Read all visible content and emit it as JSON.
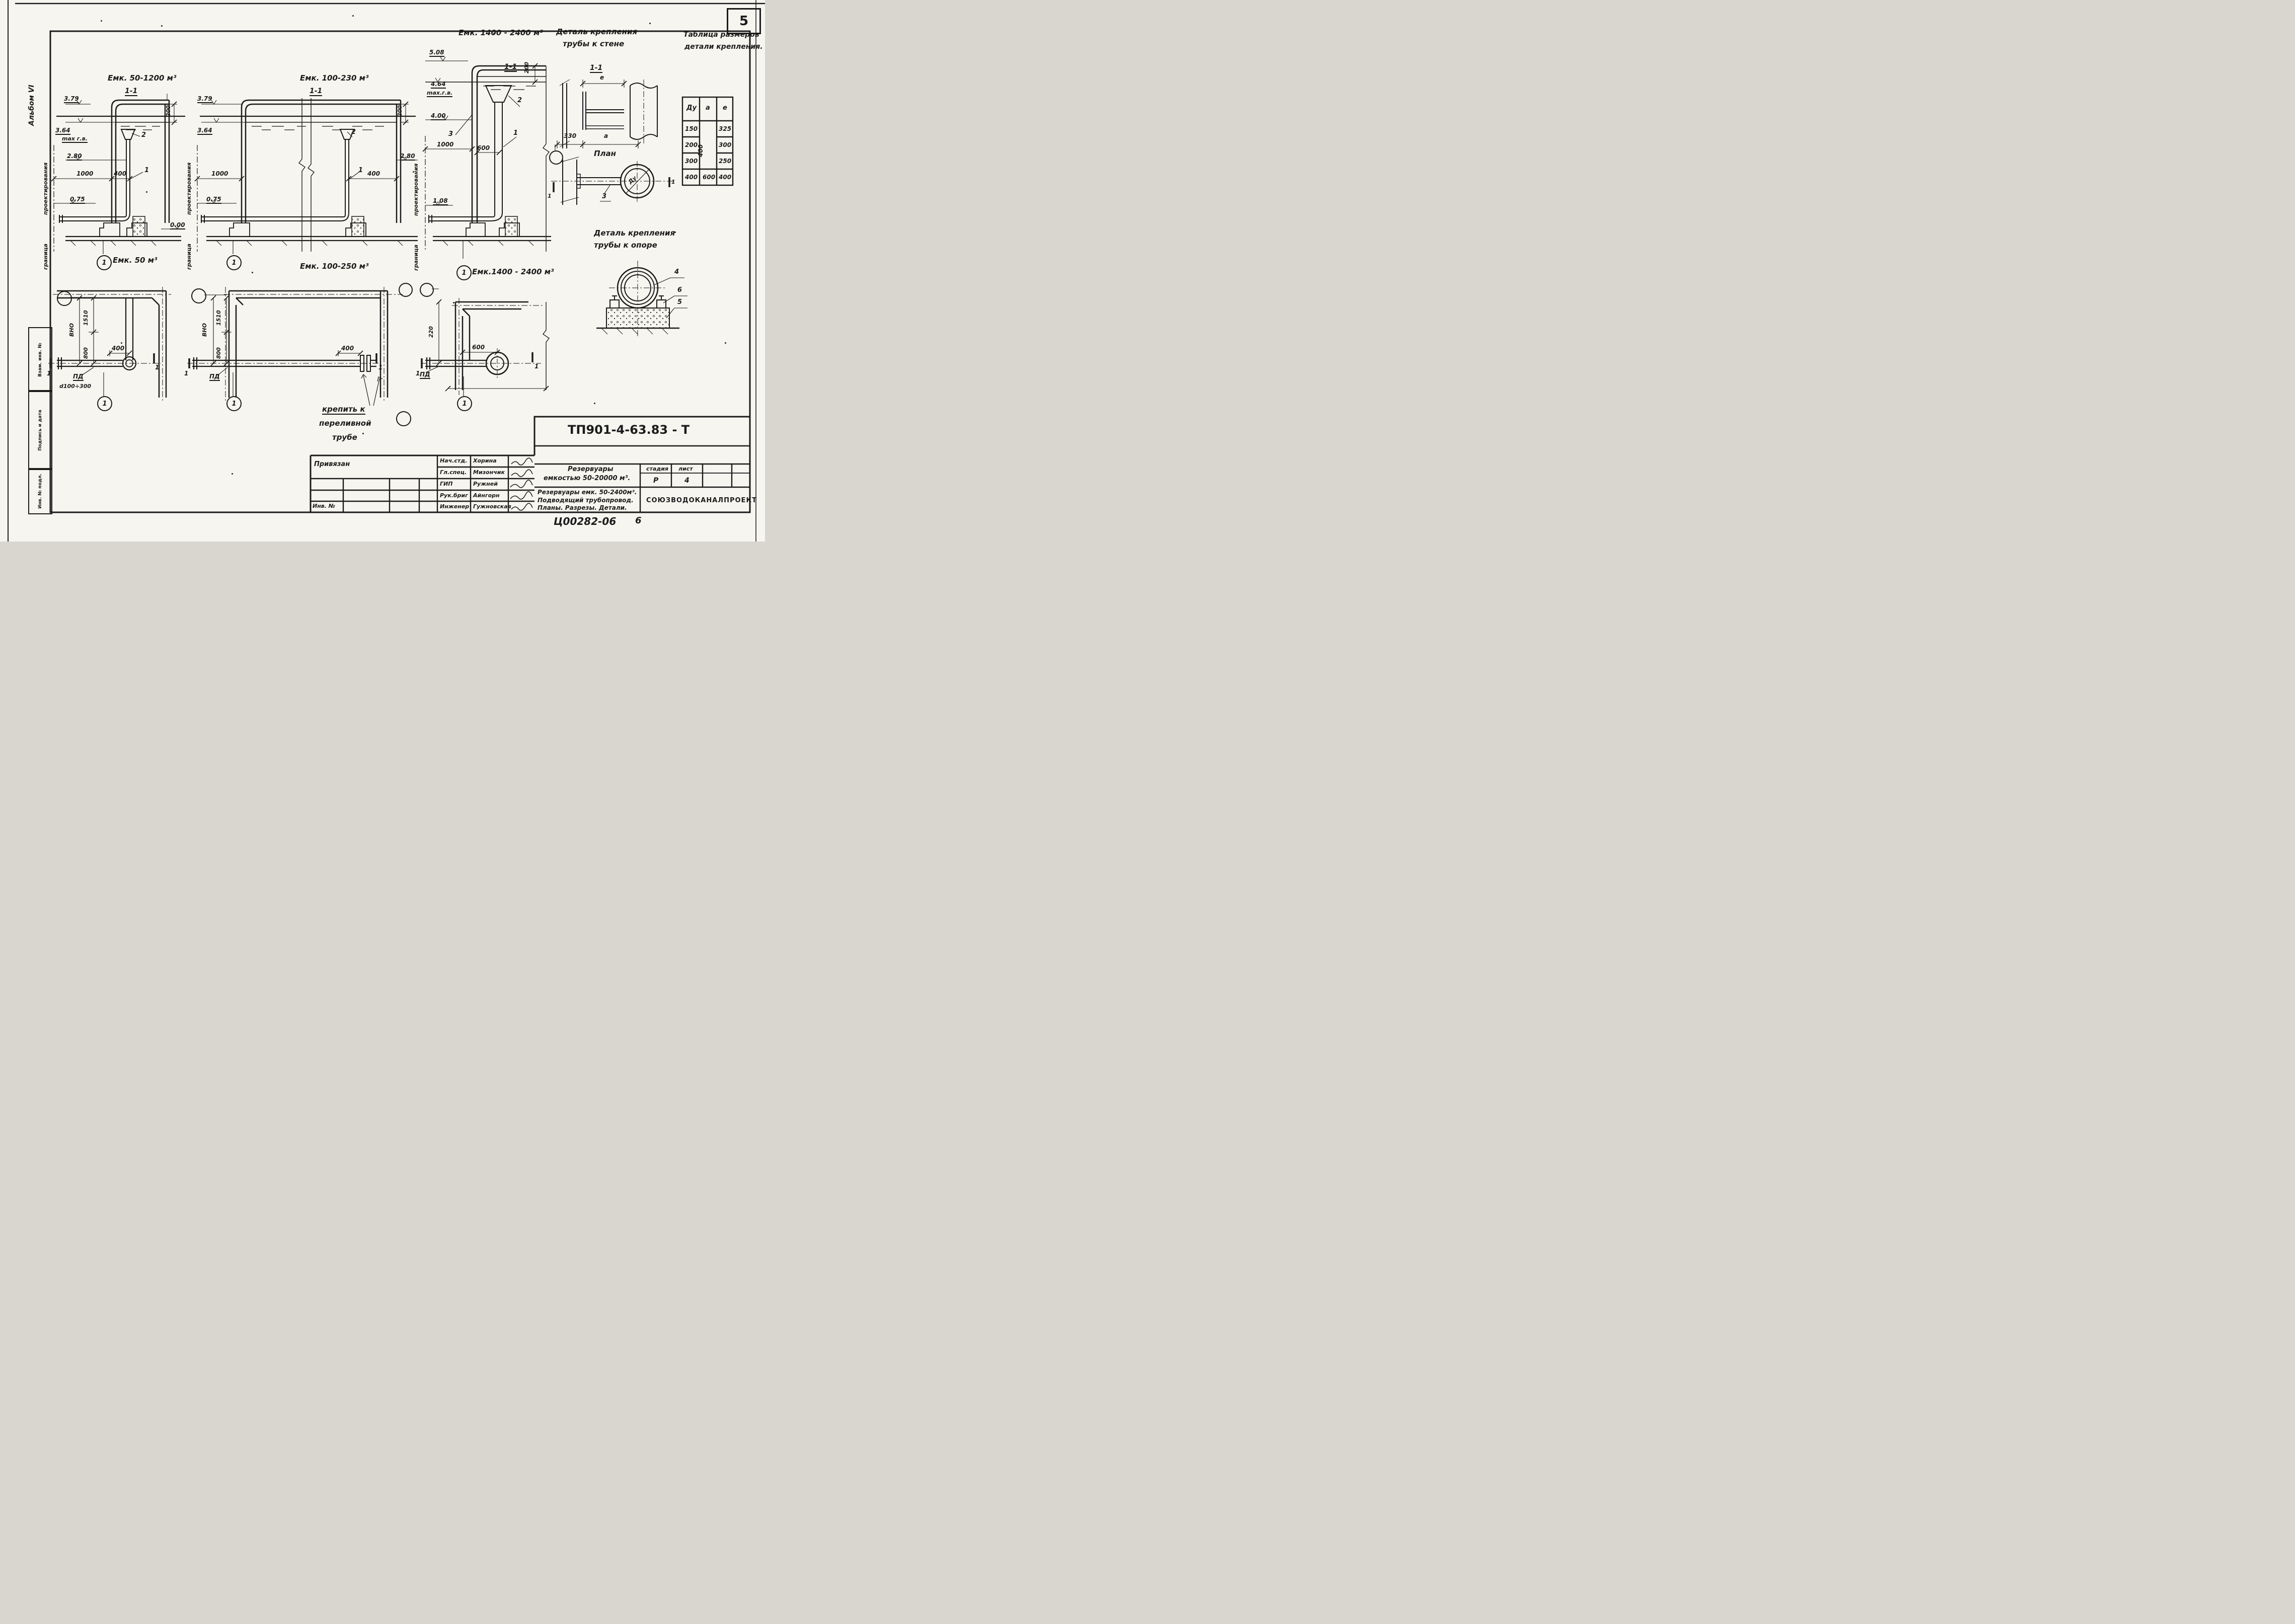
{
  "sheet": {
    "number": "5",
    "album": "Альбом VI",
    "doc_code": "Ц00282-06",
    "doc_page": "6"
  },
  "stamps": {
    "vzam": "Взам. инв. №",
    "podpis": "Подпись и дата",
    "inv_podl": "Инв. № подл."
  },
  "headers": {
    "wall_detail_1": "Деталь крепления",
    "wall_detail_2": "трубы к стене",
    "table_title_1": "Таблица размеров",
    "table_title_2": "детали крепления.",
    "support_detail_1": "Деталь крепления",
    "support_detail_2": "трубы к опоре",
    "plan_label": "План",
    "detail_mark": "1-1"
  },
  "size_table": {
    "col_dy": "Ду",
    "col_a": "а",
    "col_e": "е",
    "dy": [
      "150",
      "200",
      "300",
      "400"
    ],
    "e": [
      "325",
      "300",
      "250",
      "400"
    ],
    "a_merged": "400",
    "a_last": "600"
  },
  "sections": [
    {
      "title": "Емк. 50-1200 м³",
      "mark": "1-1",
      "elev_top": "3.79",
      "elev_water": "3.64",
      "water_note": "max г.в.",
      "roof_dim": "200",
      "elev_mid": "2.80",
      "dim_a": "1000",
      "dim_b": "400",
      "elev_low": "0.75",
      "elev_zero": "0.00",
      "callout_funnel": "2",
      "callout_pipe": "1",
      "boundary_upper": "проектирования",
      "boundary_lower": "граница",
      "bubble": "1",
      "caption": "Емк. 50 м³"
    },
    {
      "title": "Емк. 100-230 м³",
      "mark": "1-1",
      "elev_top": "3.79",
      "elev_water": "3.64",
      "roof_dim": "200",
      "elev_mid": "2.80",
      "dim_a": "1000",
      "dim_b": "400",
      "elev_low": "0.75",
      "callout_funnel": "2",
      "callout_pipe": "1",
      "boundary_upper": "проектирования",
      "boundary_lower": "граница",
      "bubble": "1",
      "caption": "Емк. 100-250 м³"
    },
    {
      "title": "Емк. 1400 - 2400 м³",
      "mark": "1-1",
      "elev_top": "5.08",
      "elev_water": "4.64",
      "water_note": "max.г.в.",
      "roof_dim": "200",
      "elev_funnel": "4.00",
      "dim_a": "1000",
      "dim_b": "600",
      "elev_low": "1.08",
      "callout_funnel": "2",
      "callout_pipe": "1",
      "callout_outlet": "3",
      "boundary_upper": "проектирования",
      "boundary_lower": "граница",
      "bubble": "1",
      "caption": "Емк.1400 - 2400 м³"
    }
  ],
  "plans": [
    {
      "dim_v1": "1510",
      "axis_label": "ВНО",
      "dim_v2": "800",
      "dim_h": "400",
      "pipe_label": "ПД",
      "note": "d100÷300",
      "bubble": "1",
      "mark_left": "1",
      "mark_right": "1"
    },
    {
      "dim_v1": "1510",
      "axis_label": "ВНО",
      "dim_v2": "800",
      "dim_h": "400",
      "pipe_label": "ПД",
      "bubble": "1",
      "mark_left": "1",
      "mark_right": "1"
    },
    {
      "dim_v": "220",
      "dim_h": "600",
      "pipe_label": "ПД",
      "bubble": "1",
      "mark_left": "1",
      "mark_right": "1"
    }
  ],
  "wall_detail": {
    "mark": "1-1",
    "dim_e": "е",
    "dim_330": "330",
    "dim_a": "а",
    "callout": "3",
    "pipe_dia": "Ду",
    "mark_left": "1",
    "mark_right": "1"
  },
  "support_detail": {
    "callout_clamp": "4",
    "callout_bolt": "6",
    "callout_pad": "5"
  },
  "note": {
    "line1": "крепить к",
    "line2": "переливной",
    "line3": "трубе"
  },
  "title_block": {
    "binding": "Привязан",
    "inv_label": "Инв. №",
    "doc_number": "ТП901-4-63.83 - Т",
    "project_1": "Резервуары",
    "project_2": "емкостью 50-20000 м³.",
    "stage_label": "стадия",
    "sheet_label": "лист",
    "stage": "Р",
    "sheet": "4",
    "subtitle_1": "Резервуары емк. 50-2400м³.",
    "subtitle_2": "Подводящий трубопровод.",
    "subtitle_3": "Планы. Разрезы. Детали.",
    "organization": "СОЮЗВОДОКАНАЛПРОЕКТ",
    "roles": [
      {
        "role": "Нач.стд.",
        "name": "Хорина"
      },
      {
        "role": "Гл.спец.",
        "name": "Мизончик"
      },
      {
        "role": "ГИП",
        "name": "Ружней"
      },
      {
        "role": "Рук.бриг",
        "name": "Айнгорн"
      },
      {
        "role": "Инженер",
        "name": "Гужновская"
      }
    ]
  }
}
